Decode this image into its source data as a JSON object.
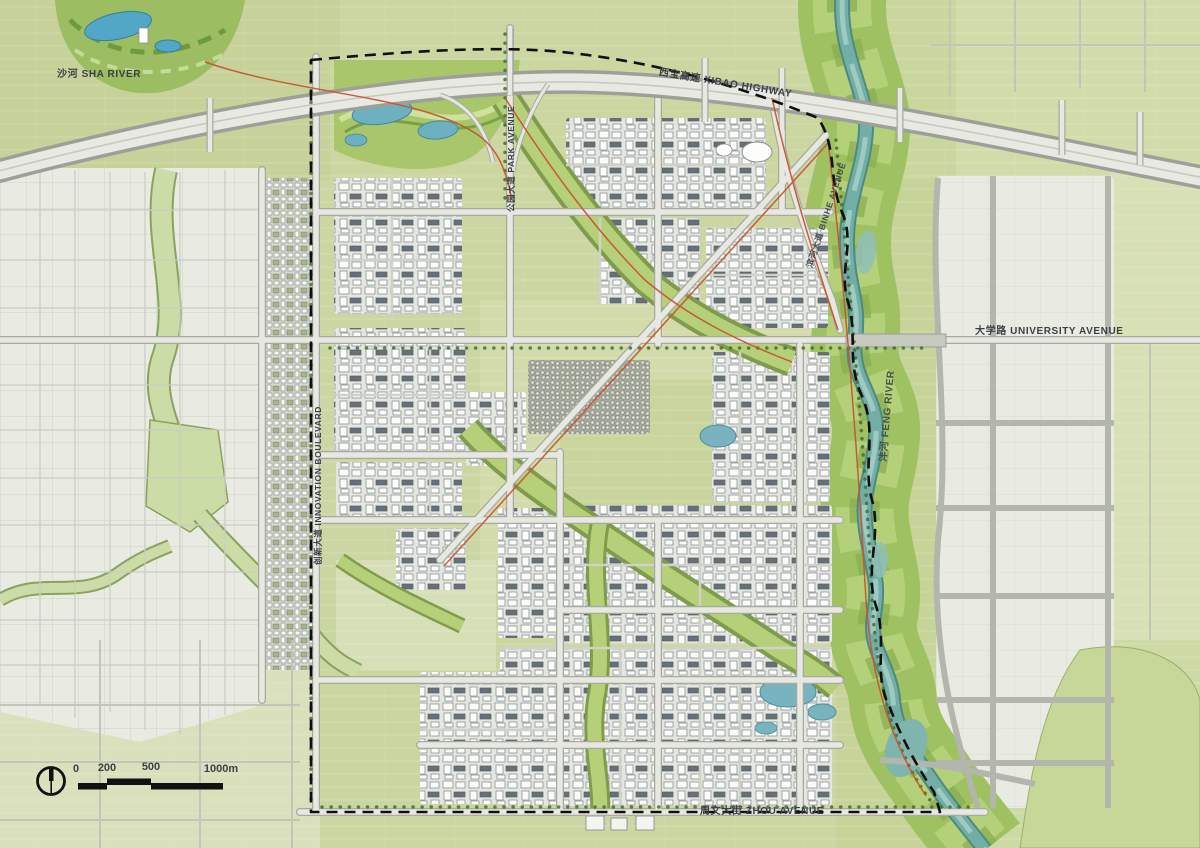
{
  "map": {
    "labels": {
      "sha_river": "沙河 SHA RIVER",
      "xibao_highway": "西宝高速 XIBAO HIGHWAY",
      "park_avenue": "公园大道 PARK AVENUE",
      "binhe_avenue": "滨河大道 BINHE AVENUE",
      "university_avenue": "大学路 UNIVERSITY AVENUE",
      "feng_river": "沣河 FENG RIVER",
      "innovation_boulevard": "创新大道 INNOVATION BOULEVARD",
      "zhou_avenue": "周文大街 ZHOU AVENUE"
    },
    "scale_bar": {
      "ticks": [
        "0",
        "200",
        "500",
        "1000m"
      ]
    },
    "colors": {
      "field": "#ccd6a2",
      "pale_urban": "#e9ebe3",
      "greenway": "#b5d078",
      "river_water": "#72aea6",
      "road_fill": "#e7e8e1",
      "boundary": "#101010",
      "transit_line": "#c85531",
      "label_text": "#3a4046"
    }
  }
}
